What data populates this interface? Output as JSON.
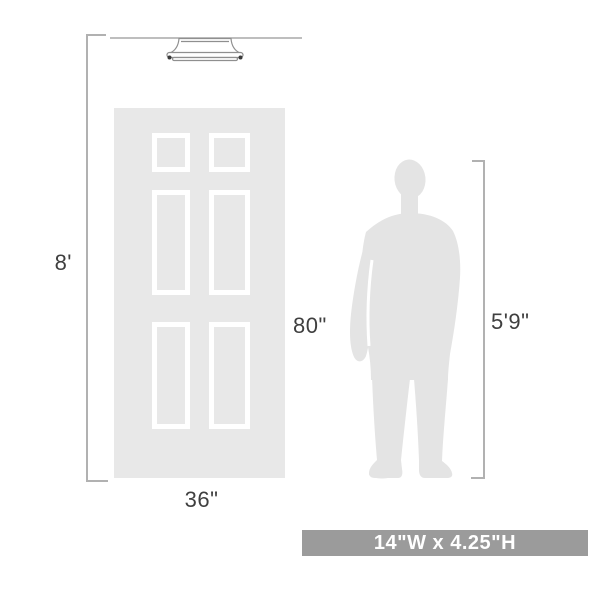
{
  "diagram": {
    "description": "Light fixture size comparison diagram with door and person silhouette",
    "labels": {
      "ceiling_height": "8'",
      "door_height": "80\"",
      "door_width": "36\"",
      "person_height": "5'9\"",
      "fixture_size": "14\"W x 4.25\"H"
    },
    "colors": {
      "door_fill": "#e8e8e8",
      "door_border": "#a8a8a8",
      "panel_outline": "#ffffff",
      "silhouette": "#e4e4e4",
      "bracket_line": "#b1b1b1",
      "ceiling_line": "#a9a9a9",
      "fixture_outline": "#8f8f8f",
      "fixture_fill": "#ffffff",
      "finial_dot": "#3a3a3a",
      "label_text": "#3f3f3f",
      "badge_bg": "#9b9b9b",
      "badge_text": "#ffffff"
    }
  }
}
